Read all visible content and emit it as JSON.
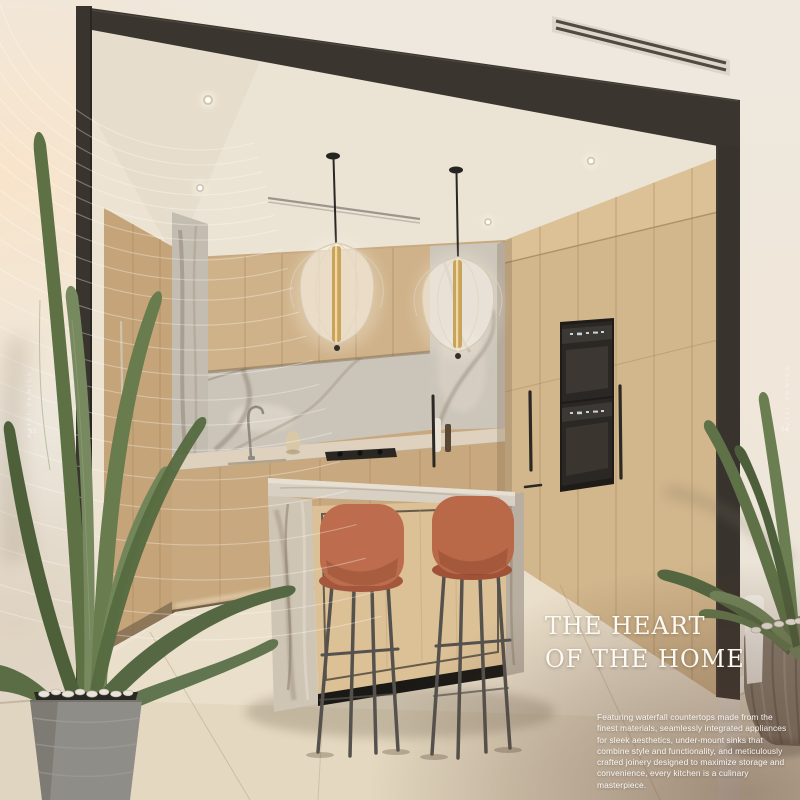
{
  "page": {
    "heading": {
      "line1": "THE HEART",
      "line2": "OF THE HOME"
    },
    "body_text": "Featuring waterfall countertops made from the finest materials, seamlessly integrated appliances for sleek aesthetics, under-mount sinks that combine style and functionality, and meticulously crafted joinery designed to maximize storage and convenience, every kitchen is a culinary masterpiece.",
    "watermarks": {
      "left_text": "AZIZI VENICE",
      "left_page": "53",
      "right_text": "AZIZI VENICE",
      "right_page": "54"
    }
  },
  "colors": {
    "wall": "#ece6dc",
    "wall_warm": "#f8e8d2",
    "frame": "#3a352f",
    "ceiling": "#ebe3d4",
    "wood_light": "#dcc096",
    "wood_mid": "#c8a87e",
    "wood_dark": "#b2905f",
    "marble_light": "#d8d0c3",
    "marble_vein": "#8d8173",
    "counter": "#ded2bf",
    "floor": "#e4d8c0",
    "stool_terracotta": "#bd6d4d",
    "stool_legs": "#55524e",
    "brass": "#c9a25c",
    "leaf_green": "#64784a",
    "pot_left": "#8f8d87",
    "pot_right": "#877c6e",
    "text_white": "#fcfaf4"
  }
}
